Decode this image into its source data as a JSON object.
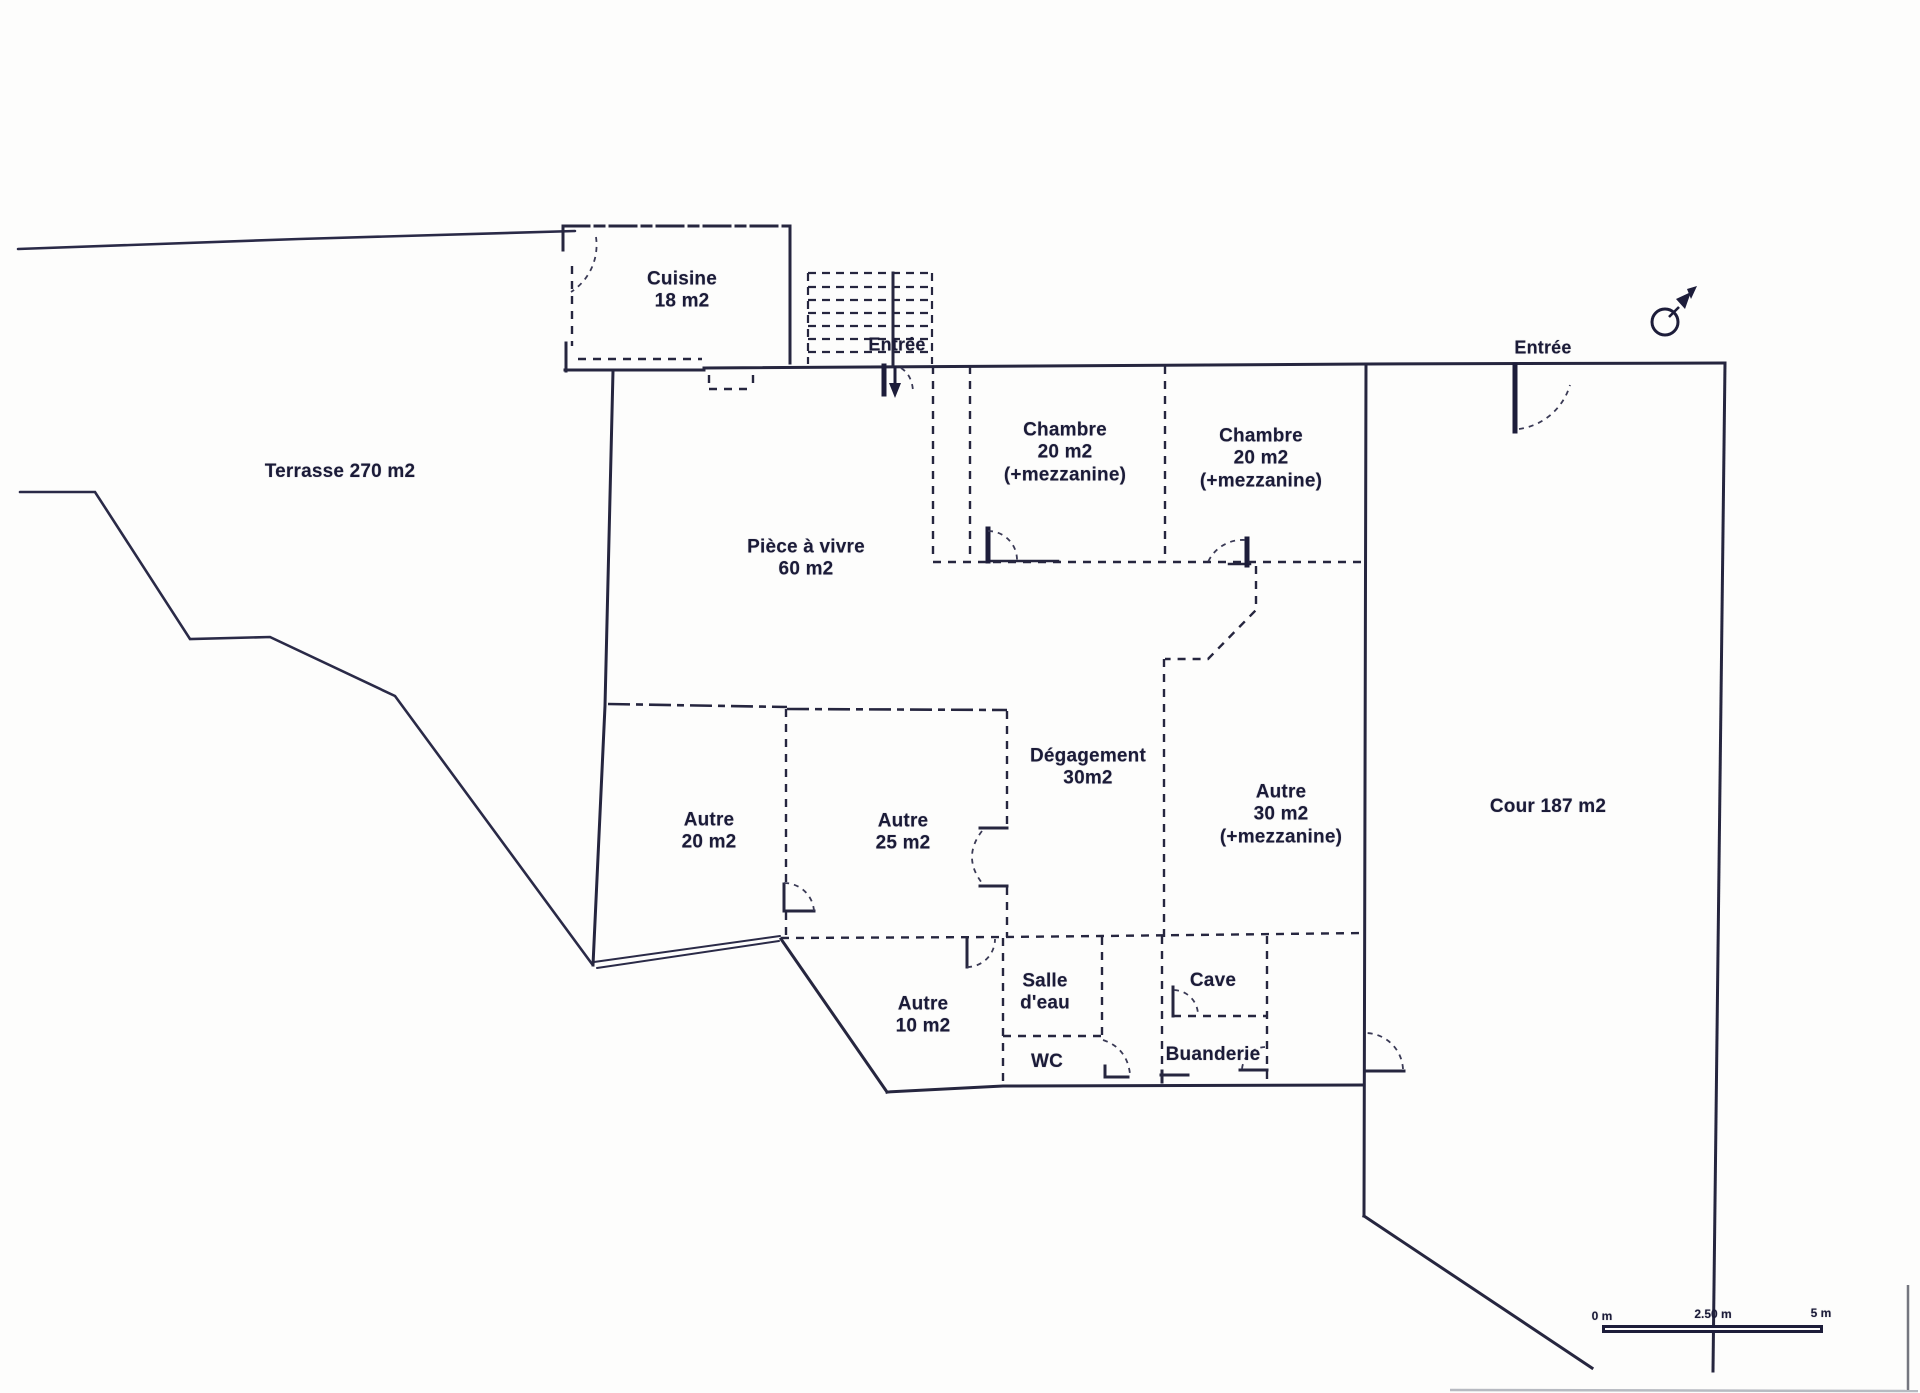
{
  "document": {
    "type": "plan d'étage scanné",
    "ink_color": "#28284a",
    "paper_color": "#fdfdfc"
  },
  "labels": {
    "terrasse": "Terrasse 270 m2",
    "cour": "Cour 187 m2",
    "entree_left": "Entrée",
    "entree_right": "Entrée"
  },
  "rooms": {
    "cuisine": {
      "name": "Cuisine",
      "area": "18 m2"
    },
    "piece_a_vivre": {
      "name": "Pièce à vivre",
      "area": "60 m2"
    },
    "chambre_1": {
      "name": "Chambre",
      "area": "20 m2",
      "note": "(+mezzanine)"
    },
    "chambre_2": {
      "name": "Chambre",
      "area": "20 m2",
      "note": "(+mezzanine)"
    },
    "degagement": {
      "name": "Dégagement",
      "area": "30m2"
    },
    "autre_20": {
      "name": "Autre",
      "area": "20 m2"
    },
    "autre_25": {
      "name": "Autre",
      "area": "25 m2"
    },
    "autre_30": {
      "name": "Autre",
      "area": "30 m2",
      "note": "(+mezzanine)"
    },
    "autre_10": {
      "name": "Autre",
      "area": "10 m2"
    },
    "salle_eau": {
      "line1": "Salle",
      "line2": "d'eau"
    },
    "wc": {
      "name": "WC"
    },
    "cave": {
      "name": "Cave"
    },
    "buanderie": {
      "name": "Buanderie"
    }
  },
  "scale_bar": {
    "zero": "0 m",
    "mid": "2.50 m",
    "end": "5 m"
  }
}
